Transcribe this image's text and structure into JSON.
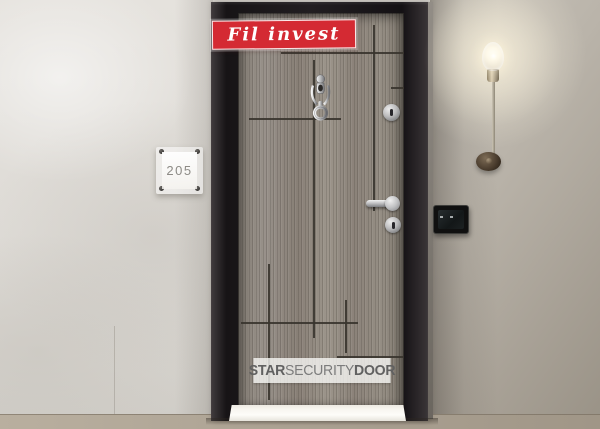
{
  "banner": {
    "label": "Fil invest",
    "bg_color": "#d42a33",
    "text_color": "#ffffff"
  },
  "room_plate": {
    "number": "205"
  },
  "watermark": {
    "star": "STAR",
    "security": "SECURITY",
    "door": "DOOR",
    "text_color": "#6a6a6a"
  },
  "door": {
    "leaf_color": "#8f887e",
    "groove_color": "#39342d",
    "frame_color": "#1b1719",
    "hardware": [
      "door-knocker",
      "key-cylinder-top",
      "lever-handle",
      "key-cylinder-bottom"
    ]
  },
  "walls": {
    "left_color": "#dedbd6",
    "right_color": "#aaa398",
    "floor_color": "#aba192"
  },
  "fixtures": {
    "lamp": "bare-bulb-wall-sconce",
    "doorbell": "black-switch-plate"
  }
}
